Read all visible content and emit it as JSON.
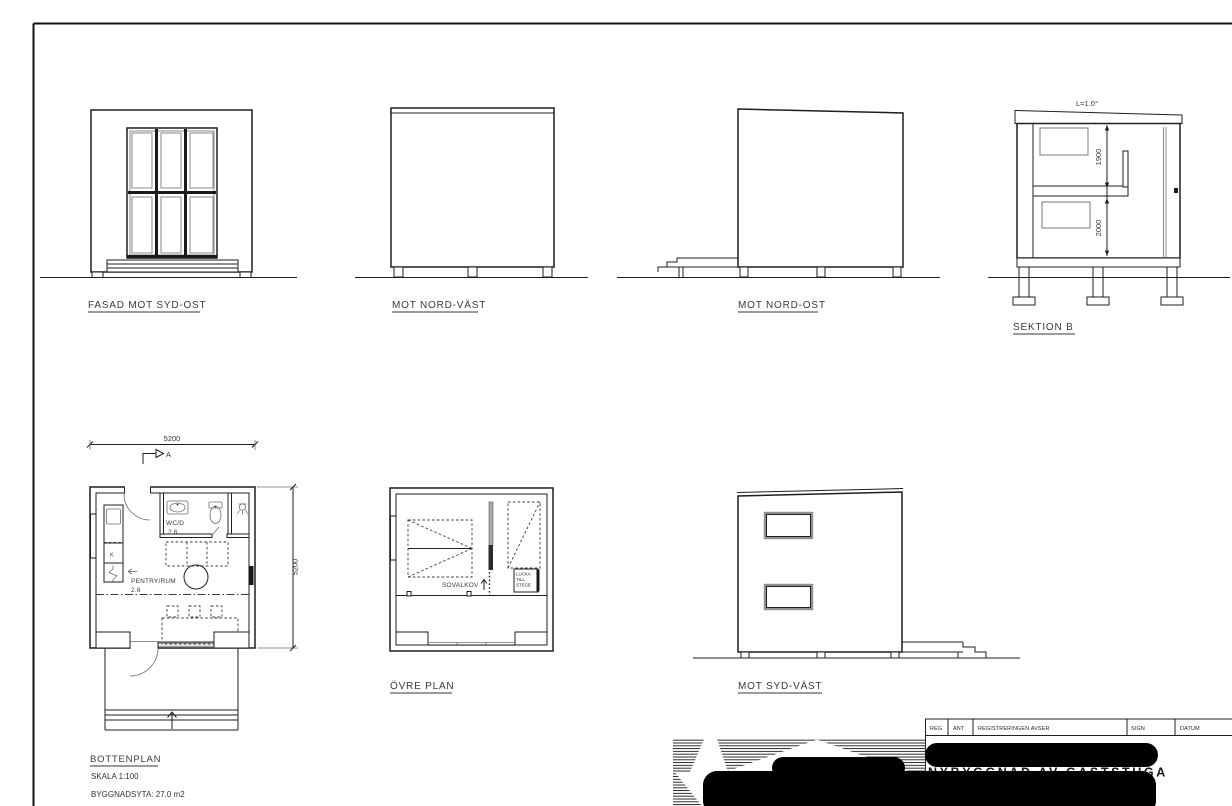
{
  "sheet": {
    "elevations": {
      "fasad_syd_ost": "FASAD MOT SYD-OST",
      "nord_vast": "MOT NORD-VÄST",
      "nord_ost": "MOT NORD-OST",
      "syd_vast": "MOT SYD-VÄST"
    },
    "section": {
      "label": "SEKTION B",
      "roof_slope": "L=1.0°",
      "dim_upper": "1900",
      "dim_lower": "2000"
    },
    "bottenplan": {
      "label": "BOTTENPLAN",
      "scale": "SKALA 1:100",
      "area": "BYGGNADSYTA: 27.0 m2",
      "dim_top": "5200",
      "dim_right": "5200",
      "section_marker": "A",
      "wc_name": "WC/D",
      "wc_area": "2.6",
      "pentry_name": "PENTRY/RUM",
      "pentry_area": "2.6",
      "kitchen_unit": "K"
    },
    "ovre_plan": {
      "label": "ÖVRE PLAN",
      "sovalkov": "SOVALKOV",
      "lucka_line1": "LUCKA",
      "lucka_line2": "TILL",
      "lucka_line3": "STEGE"
    },
    "title_block": {
      "headers": {
        "reg": "REG",
        "ant": "ANT",
        "registreringen": "REGISTRERINGEN AVSER",
        "sign": "SIGN",
        "datum": "DATUM"
      },
      "partial_text": "NYBYGGNAD AV GÄSTSTUGA"
    }
  }
}
